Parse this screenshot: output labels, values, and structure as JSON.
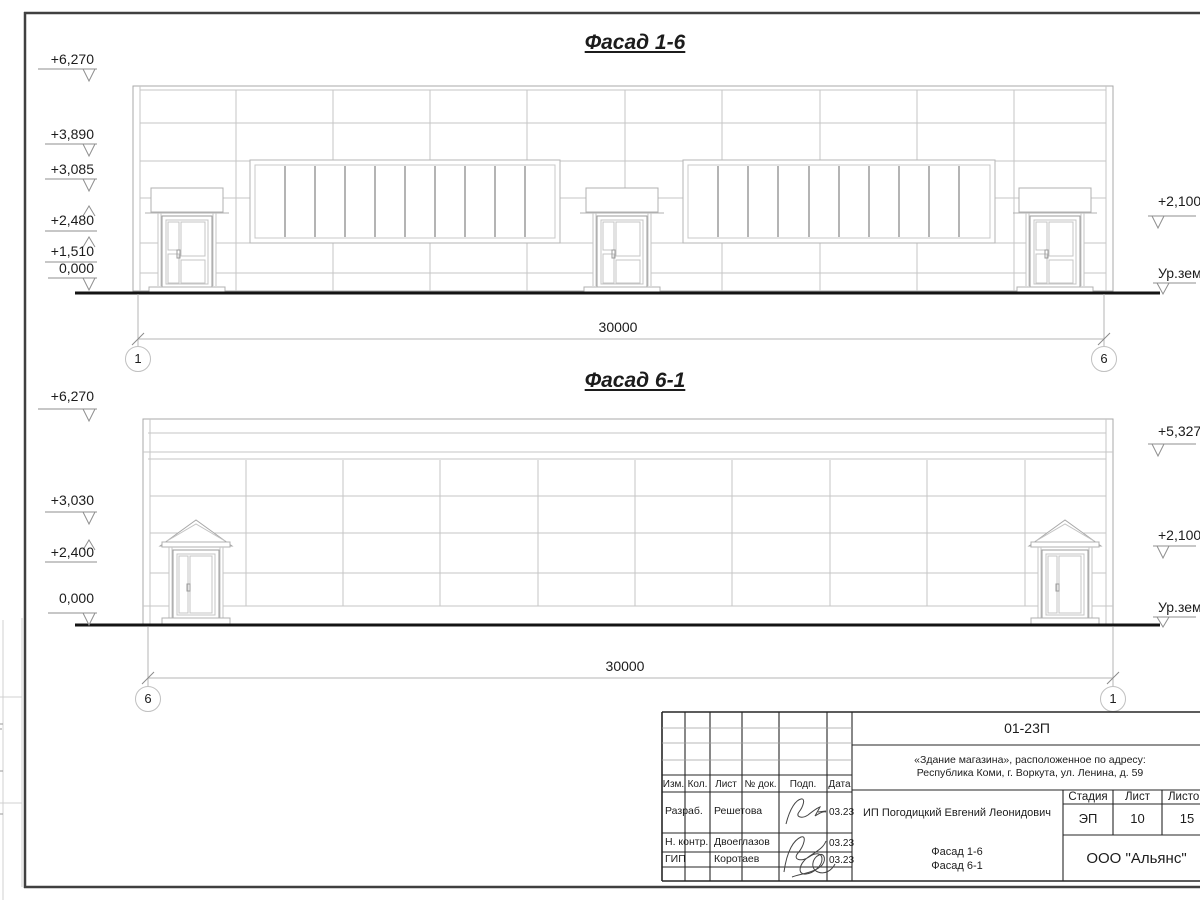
{
  "facade_16": {
    "title": "Фасад 1-6",
    "marks_left": [
      "+6,270",
      "+3,890",
      "+3,085",
      "+2,480",
      "+1,510",
      "0,000"
    ],
    "marks_right": [
      "+2,100",
      "Ур.зем"
    ],
    "dimension": "30000",
    "axis_left": "1",
    "axis_right": "6"
  },
  "facade_61": {
    "title": "Фасад 6-1",
    "marks_left": [
      "+6,270",
      "+3,030",
      "+2,400",
      "0,000"
    ],
    "marks_right": [
      "+5,327",
      "+2,100",
      "Ур.зем"
    ],
    "dimension": "30000",
    "axis_left": "6",
    "axis_right": "1"
  },
  "title_block": {
    "doc_number": "01-23П",
    "object_address_line1": "«Здание магазина», расположенное по адресу:",
    "object_address_line2": "Республика Коми, г. Воркута, ул. Ленина, д. 59",
    "columns": [
      "Изм.",
      "Кол.",
      "Лист",
      "№ док.",
      "Подп.",
      "Дата"
    ],
    "signers": [
      {
        "role": "Разраб.",
        "name": "Решетова",
        "date": "03.23"
      },
      {
        "role": "Н. контр.",
        "name": "Двоеглазов",
        "date": "03.23"
      },
      {
        "role": "ГИП",
        "name": "Коротаев",
        "date": "03.23"
      }
    ],
    "client": "ИП Погодицкий Евгений Леонидович",
    "stage_header": "Стадия",
    "sheet_header": "Лист",
    "sheets_header": "Листо",
    "stage": "ЭП",
    "sheet_number": "10",
    "sheets_total": "15",
    "drawing_title_line1": "Фасад 1-6",
    "drawing_title_line2": "Фасад 6-1",
    "company": "ООО \"Альянс\""
  },
  "colors": {
    "paper": "#ffffff",
    "line_light": "#c3c3c3",
    "line_dark": "#2b2b2b",
    "ink": "#1a1a1a"
  }
}
